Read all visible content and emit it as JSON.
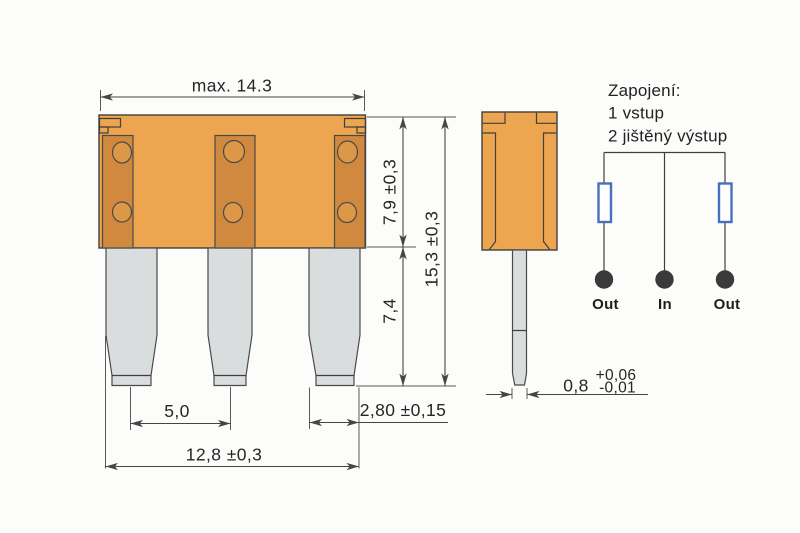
{
  "colors": {
    "body_orange": "#EDA64F",
    "strip_orange": "#D0893E",
    "hole_orange": "#DC9846",
    "blade_gray": "#D9DDDE",
    "outline": "#3F3F3F",
    "fuse_symbol_blue": "#4A6FBE",
    "node_dark": "#3A3A3A",
    "background": "#FCFCFB"
  },
  "front_view": {
    "label_width_top": "max. 14.3",
    "label_body_height": "7,9 ±0,3",
    "label_total_height": "15,3 ±0,3",
    "label_blade_length": "7,4",
    "label_pin_pitch": "5,0",
    "label_blade_width": "2,80 ±0,15",
    "label_width_bottom": "12,8 ±0,3"
  },
  "side_view": {
    "label_thickness": "0,8",
    "label_tolerance_plus": "+0,06",
    "label_tolerance_minus": "-0,01"
  },
  "schematic": {
    "title": "Zapojení:",
    "line_input": "1 vstup",
    "line_output": "2 jištěný výstup",
    "terminal_labels": [
      "Out",
      "In",
      "Out"
    ]
  }
}
